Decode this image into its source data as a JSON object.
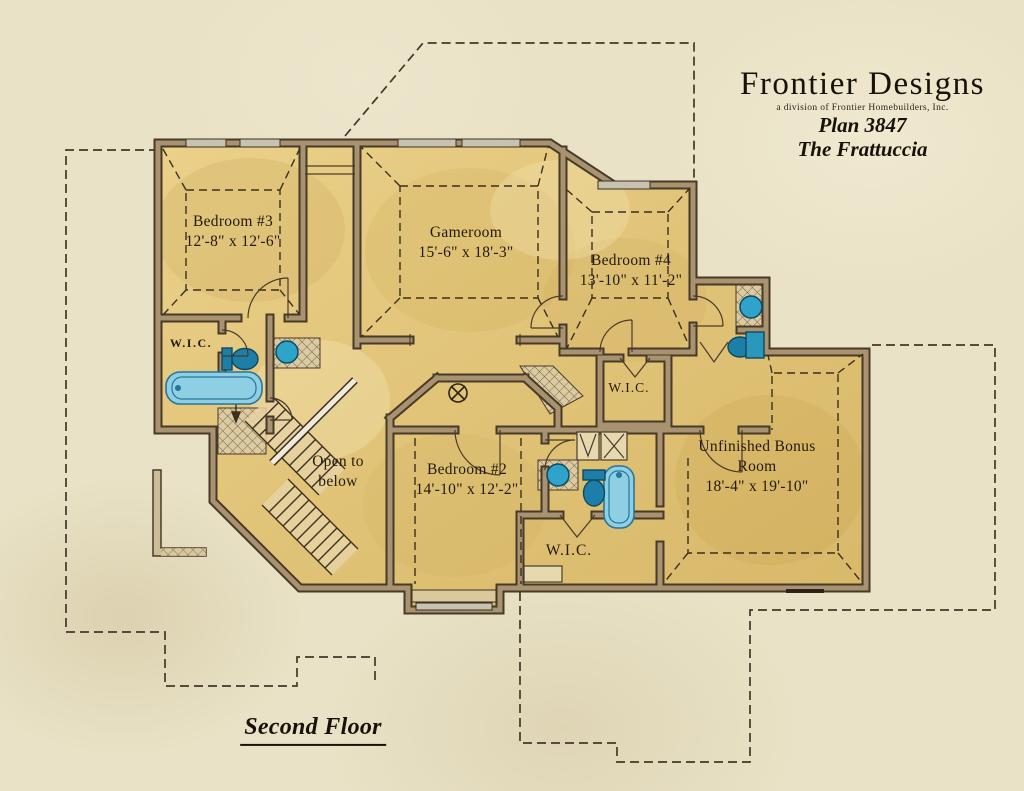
{
  "title_block": {
    "brand": "Frontier Designs",
    "tagline": "a division of Frontier Homebuilders, Inc.",
    "plan_number": "Plan 3847",
    "plan_name": "The Frattuccia"
  },
  "floor_title": "Second Floor",
  "rooms": [
    {
      "id": "bedroom-3",
      "name": "Bedroom #3",
      "dims": "12'-8\" x 12'-6\""
    },
    {
      "id": "gameroom",
      "name": "Gameroom",
      "dims": "15'-6\" x 18'-3\""
    },
    {
      "id": "bedroom-4",
      "name": "Bedroom #4",
      "dims": "13'-10\" x 11'-2\""
    },
    {
      "id": "bedroom-2",
      "name": "Bedroom #2",
      "dims": "14'-10\" x 12'-2\""
    },
    {
      "id": "bonus-room",
      "name": "Unfinished Bonus Room",
      "dims": "18'-4\" x 19'-10\""
    }
  ],
  "annotations": {
    "open_to_below": "Open to below",
    "closet_label": "W.I.C."
  },
  "colors": {
    "parchment": "#e9e2c6",
    "room_gold": "#e2c77c",
    "wall_dark": "#463a28",
    "wall_light": "#a8926f",
    "fixture_teal": "#1d7fa8",
    "tub_blue": "#8ecfe3",
    "ink": "#221a0c"
  },
  "icons": {
    "staircase": "diagonal-treads",
    "toilet": "tank-and-bowl-oval",
    "bathtub": "rounded-rect-basin",
    "sink": "round-basin",
    "shower": "small-stall",
    "ceiling_light": "circled-cross",
    "door": "quarter-arc-swing",
    "window": "gray-wall-inset"
  }
}
